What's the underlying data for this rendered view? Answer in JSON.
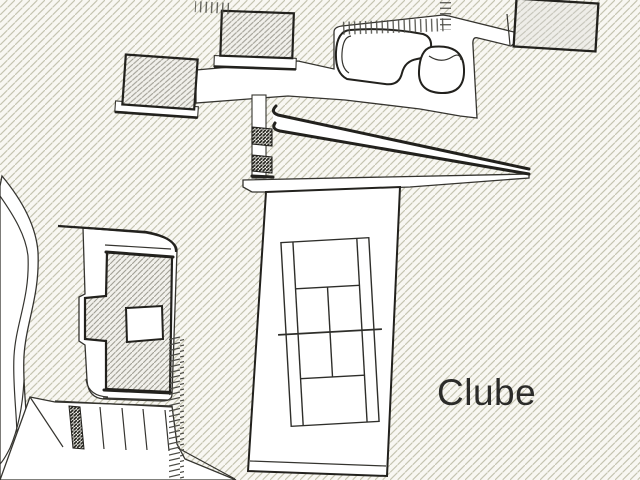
{
  "site_plan": {
    "label_clube": "Clube",
    "colors": {
      "bg": "#f8f7f2",
      "hatch_line": "#c5c4b1",
      "roof_hatch_line": "#a19f95",
      "building_c_hatch_line": "#c2c1b6",
      "dark_hatch_line": "#2a2a24",
      "outline": "#22211d",
      "road_line": "#35342f",
      "tick": "#4b4b45",
      "text": "#2b2b29",
      "white": "#ffffff"
    },
    "features": [
      "hatched-terrain-field",
      "curved-access-road",
      "parking-lot-with-stalls",
      "clubhouse-building-with-courtyard",
      "building-a",
      "building-b",
      "building-c",
      "swimming-pool",
      "pool-deck",
      "upper-walkway",
      "stairs",
      "ramp-wedge",
      "tennis-court",
      "hedge-tick-bands",
      "site-label"
    ]
  }
}
